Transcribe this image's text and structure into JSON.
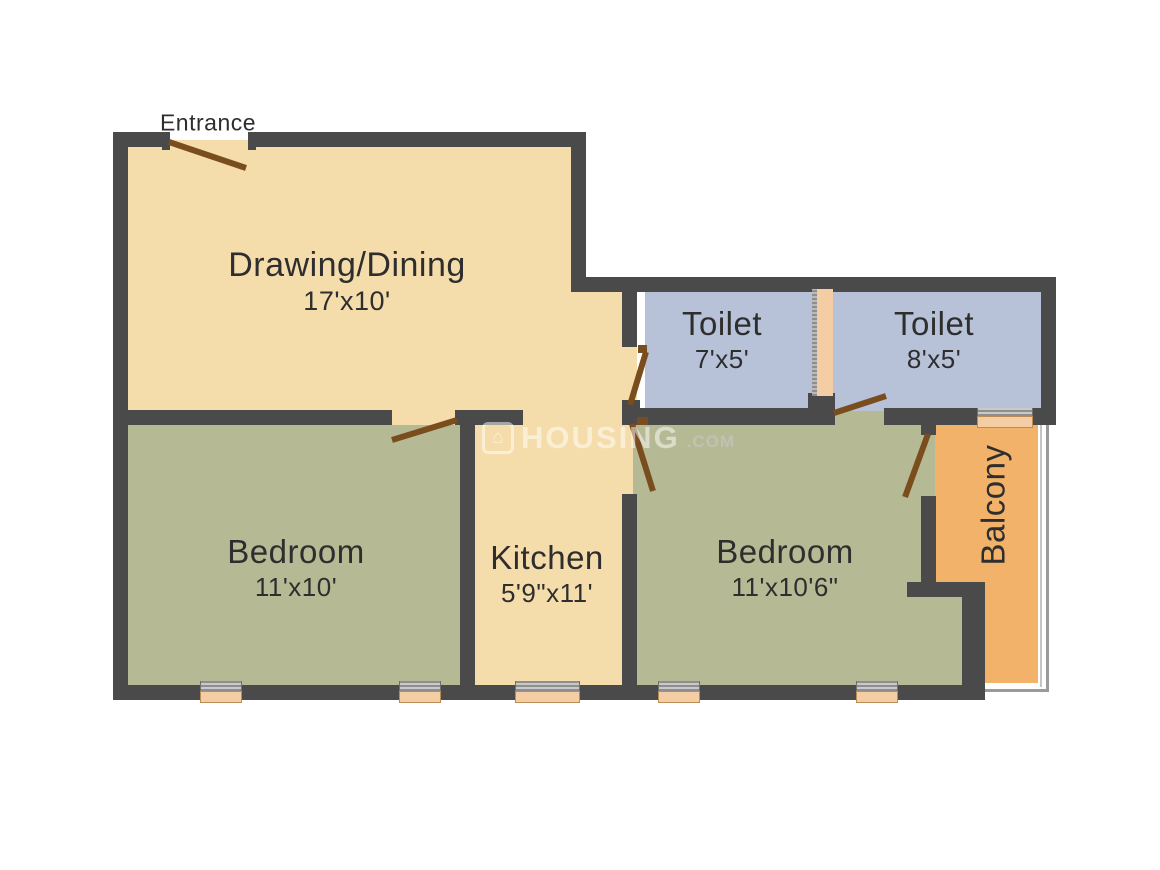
{
  "entrance": {
    "label": "Entrance"
  },
  "rooms": {
    "drawing_dining": {
      "name": "Drawing/Dining",
      "dimensions": "17'x10'"
    },
    "toilet_1": {
      "name": "Toilet",
      "dimensions": "7'x5'"
    },
    "toilet_2": {
      "name": "Toilet",
      "dimensions": "8'x5'"
    },
    "bedroom_1": {
      "name": "Bedroom",
      "dimensions": "11'x10'"
    },
    "kitchen": {
      "name": "Kitchen",
      "dimensions": "5'9\"x11'"
    },
    "bedroom_2": {
      "name": "Bedroom",
      "dimensions": "11'x10'6\""
    },
    "balcony": {
      "name": "Balcony",
      "dimensions": ""
    }
  },
  "watermark": {
    "icon": "house-icon",
    "brand": "HOUSING",
    "suffix": ".COM"
  },
  "palette": {
    "wall": "#4a4a4a",
    "living_floor": "#f5dcab",
    "bedroom_floor": "#b6ba94",
    "toilet_floor": "#b7c2d9",
    "balcony_floor": "#f2b269",
    "door_swing": "#7a4d1e",
    "window": "#f5cda5",
    "label_text": "#2e2e2e"
  }
}
